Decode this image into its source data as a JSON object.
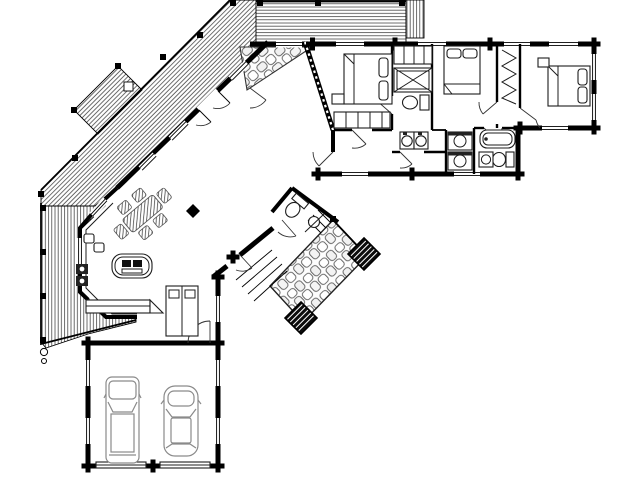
{
  "title": "log-home-floor-plan",
  "canvas": {
    "width": 640,
    "height": 480,
    "background": "#ffffff",
    "ink": "#000000",
    "vehicle_gray": "#8a8a8a",
    "stone_gray": "#666666",
    "hatch_gray": "#3c3c3c"
  },
  "labels": {
    "floor_plan": "log home first floor plan",
    "angled_deck": "angled wood deck",
    "upper_deck": "upper wood deck",
    "deck_steps": "deck steps",
    "side_deck": "side wood deck",
    "entry_walk": "stone entry porch",
    "patio": "stone patio",
    "patio_planters": "patio planters",
    "patio_steps": "patio steps",
    "living_room": "living room",
    "dining_area": "dining table with chairs",
    "kitchen": "kitchen",
    "kitchen_island": "kitchen island with cooktop",
    "range": "range",
    "kitchen_sink": "double kitchen sink",
    "refrigerator": "refrigerator cabinet",
    "counter": "kitchen counter",
    "column": "post column",
    "powder_room": "powder room",
    "foyer": "foyer",
    "master_bedroom": "master bedroom",
    "master_bed": "master bed",
    "master_bath": "master bathroom",
    "shower": "shower",
    "toilet": "toilet",
    "vanity": "double vanity sinks",
    "bedroom2": "bedroom two",
    "bedroom2_bed": "bedroom two bed",
    "closet": "closet with hanging clothes",
    "bedroom3": "bedroom three",
    "bedroom3_bed": "bedroom three bed",
    "bathroom2": "hall bathroom",
    "bathtub": "bathtub",
    "laundry": "stacked washer and dryer",
    "hallway": "hallway",
    "mudroom": "mudroom",
    "garage": "two car garage",
    "garage_doors": "garage doors",
    "truck": "pickup truck",
    "car": "car"
  }
}
